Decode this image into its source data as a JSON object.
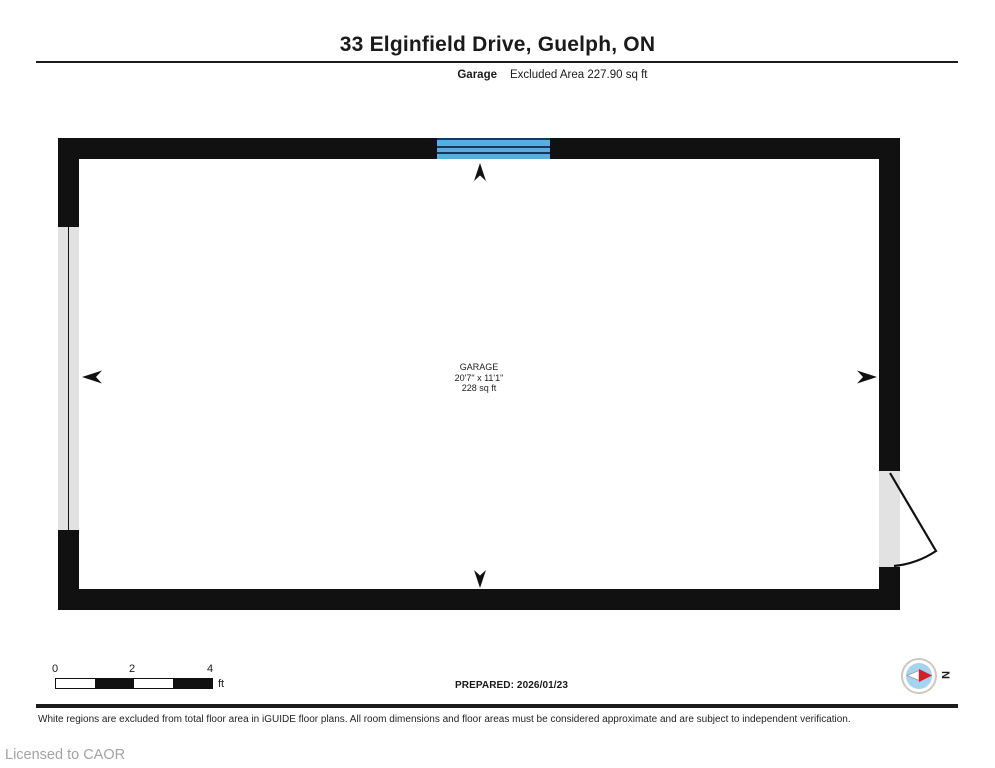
{
  "header": {
    "title": "33 Elginfield Drive, Guelph, ON",
    "floor_label": "Garage",
    "area_note": "Excluded Area 227.90 sq ft"
  },
  "room": {
    "name": "GARAGE",
    "dimensions": "20'7\" x 11'1\"",
    "area": "228 sq ft"
  },
  "scale_bar": {
    "ticks": [
      "0",
      "2",
      "4"
    ],
    "unit": "ft"
  },
  "prepared": "PREPARED: 2026/01/23",
  "compass": {
    "label": "N"
  },
  "footer": {
    "disclaimer": "White regions are excluded from total floor area in iGUIDE floor plans. All room dimensions and floor areas must be considered approximate and are subject to independent verification.",
    "license": "Licensed to CAOR"
  },
  "colors": {
    "wall": "#111111",
    "opening_gray": "#e2e2e2",
    "window_blue": "#5baddd",
    "window_line": "#17375c",
    "compass_ring": "#cdc8c1",
    "compass_blue": "#a6d3ee",
    "compass_red": "#d42127"
  }
}
